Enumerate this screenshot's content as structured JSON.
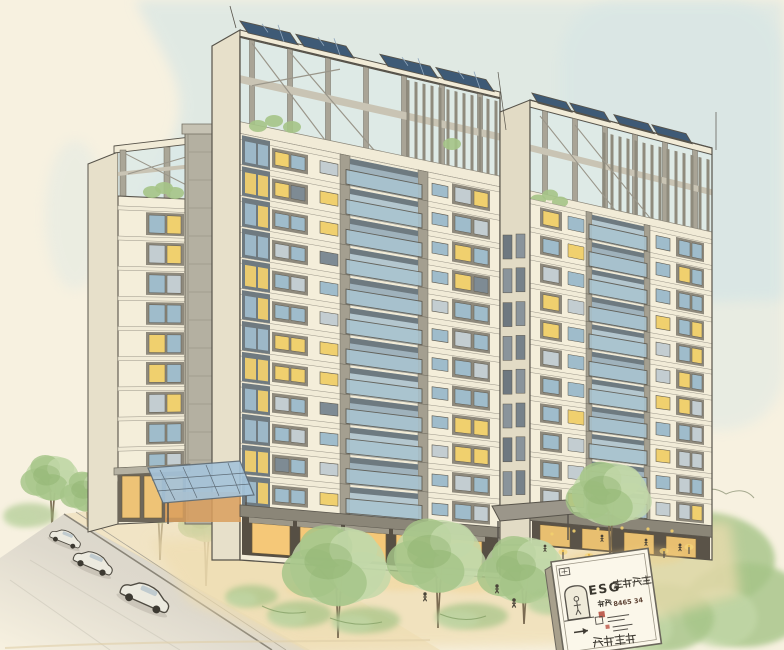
{
  "meta": {
    "title": "Watercolor architectural rendering of an ESG residential high-rise complex",
    "style": "hand-drawn ink and watercolor sketch",
    "canvas": {
      "width": 784,
      "height": 650
    }
  },
  "palette": {
    "paper": "#f7f1e0",
    "sky": "#cfe3e6",
    "wall": "#f4eeda",
    "wall_shadow": "#e7e0ca",
    "slab": "#f1ebd7",
    "frame_gray": "#8e897c",
    "concrete": "#b4b0a1",
    "ink": "#57534a",
    "glass": "#a9c4d0",
    "glass_dark": "#7e8b94",
    "lit_window": "#f0d06e",
    "storefront_glow": "#f5c878",
    "solar_panel": "#3e5a76",
    "foliage_light": "#c2d8a8",
    "foliage": "#a5c487",
    "foliage_dark": "#86ab68",
    "trunk": "#7b6b52",
    "street": "#d6d3c8",
    "plaza": "#efddb0",
    "sign_red": "#b5483a"
  },
  "window_colors": {
    "Y": "#f0d06e",
    "B": "#9fbccb",
    "G": "#c3cdd1",
    "D": "#7e8b94"
  },
  "buildings": {
    "left_tower": {
      "name": "left tower",
      "floors": 10,
      "window_pattern": "BYBGYBBGYBB",
      "features": [
        "rooftop pergola",
        "roof garden"
      ]
    },
    "main_tower": {
      "name": "main tower",
      "floors": 12,
      "window_pattern": "BYGBBYBGYBBDGYB",
      "features": [
        "rooftop pergola",
        "solar panels",
        "glass balconies",
        "roof garden"
      ],
      "solar_panels": 4
    },
    "right_tower": {
      "name": "right tower",
      "floors": 11,
      "window_pattern": "YBBGYBGBBYG",
      "features": [
        "rooftop pergola",
        "solar panels",
        "glass balconies"
      ],
      "solar_panels": 4
    }
  },
  "street": {
    "cars": 3
  },
  "plaza": {
    "people": 7,
    "bollard_lights": 6,
    "foreground_trees": 4
  },
  "sign": {
    "line1_latin": "ESG",
    "line1_cjk": "高級住宅",
    "line2_cjk": "容積",
    "line2_numbers": "8465 34",
    "line3_note": "small sketched detail lines with arrow and red seal stamps",
    "line4_cjk": "ヨ又EL",
    "icons": [
      "door-icon",
      "person-icon",
      "arrow-right-icon",
      "red-stamp"
    ]
  }
}
